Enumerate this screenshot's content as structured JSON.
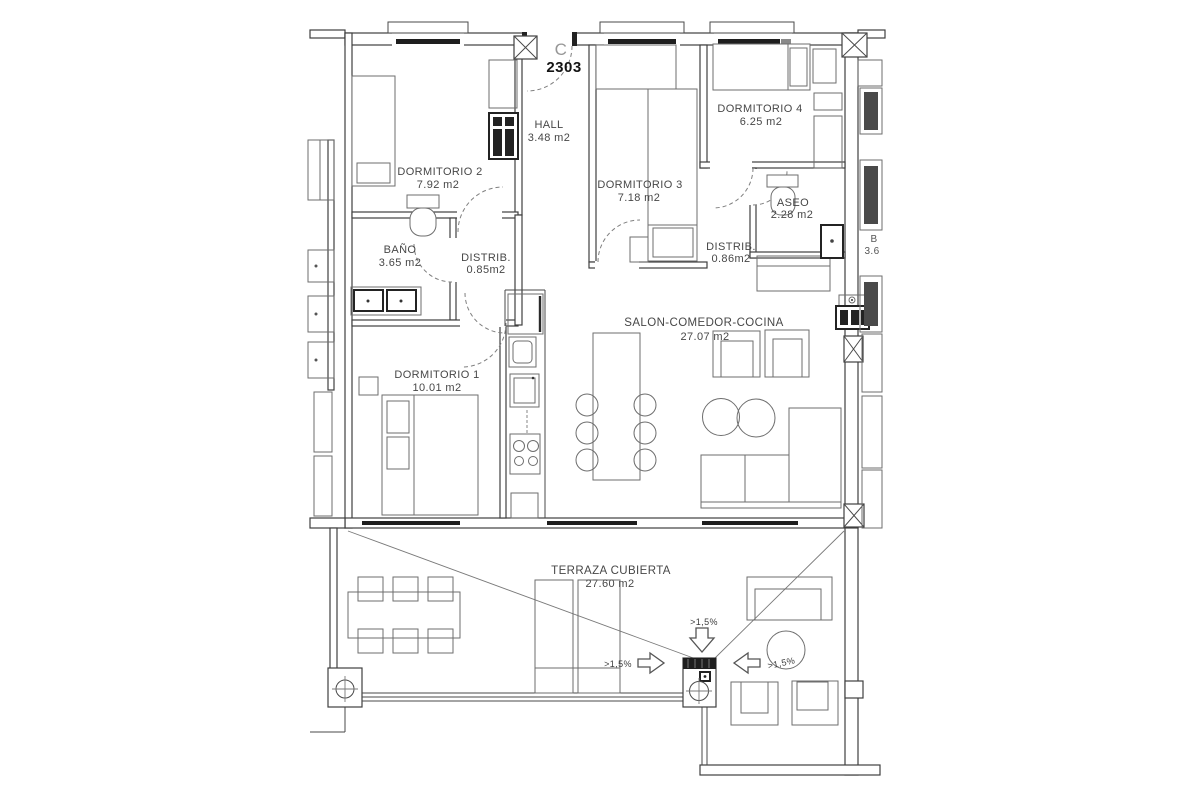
{
  "title_block": {
    "unit_letter": "C",
    "unit_number": "2303"
  },
  "rooms": {
    "hall": {
      "name": "HALL",
      "area": "3.48 m2"
    },
    "dormitorio2": {
      "name": "DORMITORIO 2",
      "area": "7.92 m2"
    },
    "dormitorio3": {
      "name": "DORMITORIO 3",
      "area": "7.18 m2"
    },
    "dormitorio4": {
      "name": "DORMITORIO 4",
      "area": "6.25 m2"
    },
    "aseo": {
      "name": "ASEO",
      "area": "2.28 m2"
    },
    "bano": {
      "name": "BAÑO",
      "area": "3.65 m2"
    },
    "distrib1": {
      "name": "DISTRIB.",
      "area": "0.85m2"
    },
    "distrib2": {
      "name": "DISTRIB.",
      "area": "0.86m2"
    },
    "dormitorio1": {
      "name": "DORMITORIO 1",
      "area": "10.01 m2"
    },
    "salon": {
      "name": "SALON-COMEDOR-COCINA",
      "area": "27.07 m2"
    },
    "terraza": {
      "name": "TERRAZA CUBIERTA",
      "area": "27.60 m2"
    }
  },
  "neighbor": {
    "name": "B",
    "area": "3.6"
  },
  "slopes": {
    "down": ">1,5%",
    "right": ">1,5%",
    "left": ">1,5%"
  },
  "colors": {
    "wall": "#3f3f3f",
    "furniture": "#6e6e6e",
    "glazing": "#1e1e1e",
    "text": "#474747",
    "background": "#ffffff"
  }
}
